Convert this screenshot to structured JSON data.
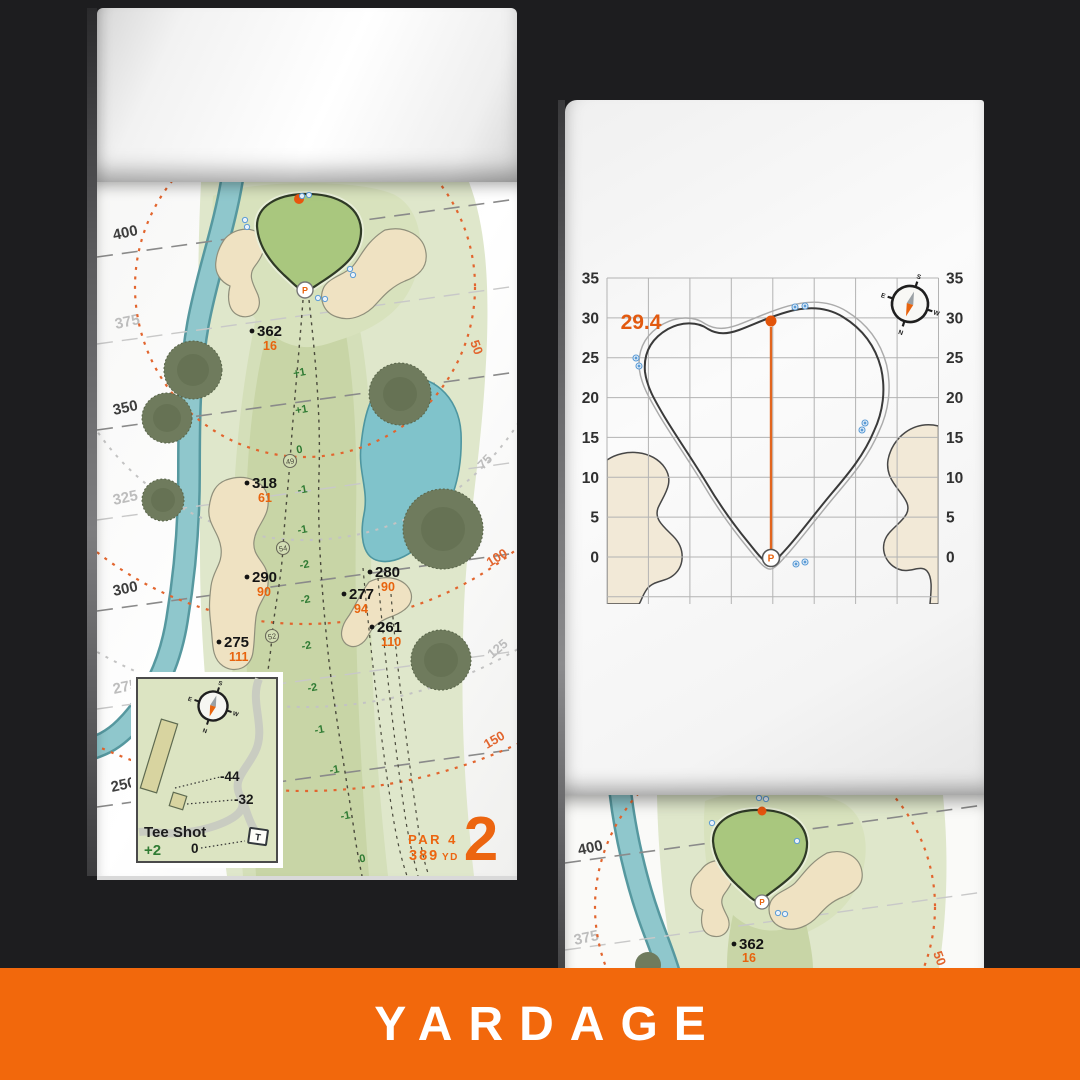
{
  "colors": {
    "accent": "#EC6510",
    "banner_bg": "#F2680C",
    "elevation_green": "#2F7B33",
    "water": "#80C3CB",
    "sand": "#EFE2C2",
    "dark_distance_line": "#3E3E3E",
    "light_distance_line": "#BDBDBD",
    "blue_mark": "#5B9BD5"
  },
  "banner": {
    "label": "YARDAGE"
  },
  "hole": {
    "number": "2",
    "par": "PAR 4",
    "yards_num": "389",
    "yards_unit": "YD"
  },
  "left_map": {
    "distance_labels": [
      {
        "t": "400"
      },
      {
        "t": "375"
      },
      {
        "t": "350"
      },
      {
        "t": "325"
      },
      {
        "t": "300"
      },
      {
        "t": "275"
      },
      {
        "t": "250"
      }
    ],
    "arc_labels": [
      {
        "t": "50"
      },
      {
        "t": "75"
      },
      {
        "t": "100"
      },
      {
        "t": "125"
      },
      {
        "t": "150"
      }
    ],
    "points": [
      {
        "d": "362",
        "s": "16"
      },
      {
        "d": "318",
        "s": "61"
      },
      {
        "d": "290",
        "s": "90"
      },
      {
        "d": "275",
        "s": "111"
      },
      {
        "d": "280",
        "s": "90"
      },
      {
        "d": "277",
        "s": "94"
      },
      {
        "d": "261",
        "s": "110"
      }
    ],
    "waypoints": [
      "49",
      "54",
      "52"
    ],
    "elevations": [
      "+1",
      "+1",
      "0",
      "-1",
      "-1",
      "-2",
      "-2",
      "-2",
      "-2",
      "-1",
      "-1",
      "-1",
      "0"
    ],
    "pin_letter": "P",
    "tee_inset": {
      "title": "Tee Shot",
      "score": "+2",
      "zero": "0",
      "dist_a": "-44",
      "dist_b": "-32",
      "tee_marker": "T"
    },
    "compass": {
      "n": "N",
      "e": "E",
      "s": "S",
      "w": "W"
    }
  },
  "green_page": {
    "pin_depth": "29.4",
    "axis": [
      "35",
      "30",
      "25",
      "20",
      "15",
      "10",
      "5",
      "0"
    ],
    "pin_letter": "P",
    "compass": {
      "n": "N",
      "e": "E",
      "s": "S",
      "w": "W"
    }
  },
  "next_page": {
    "d400": "400",
    "d375": "375",
    "point": {
      "d": "362",
      "s": "16"
    },
    "arc50": "50"
  }
}
